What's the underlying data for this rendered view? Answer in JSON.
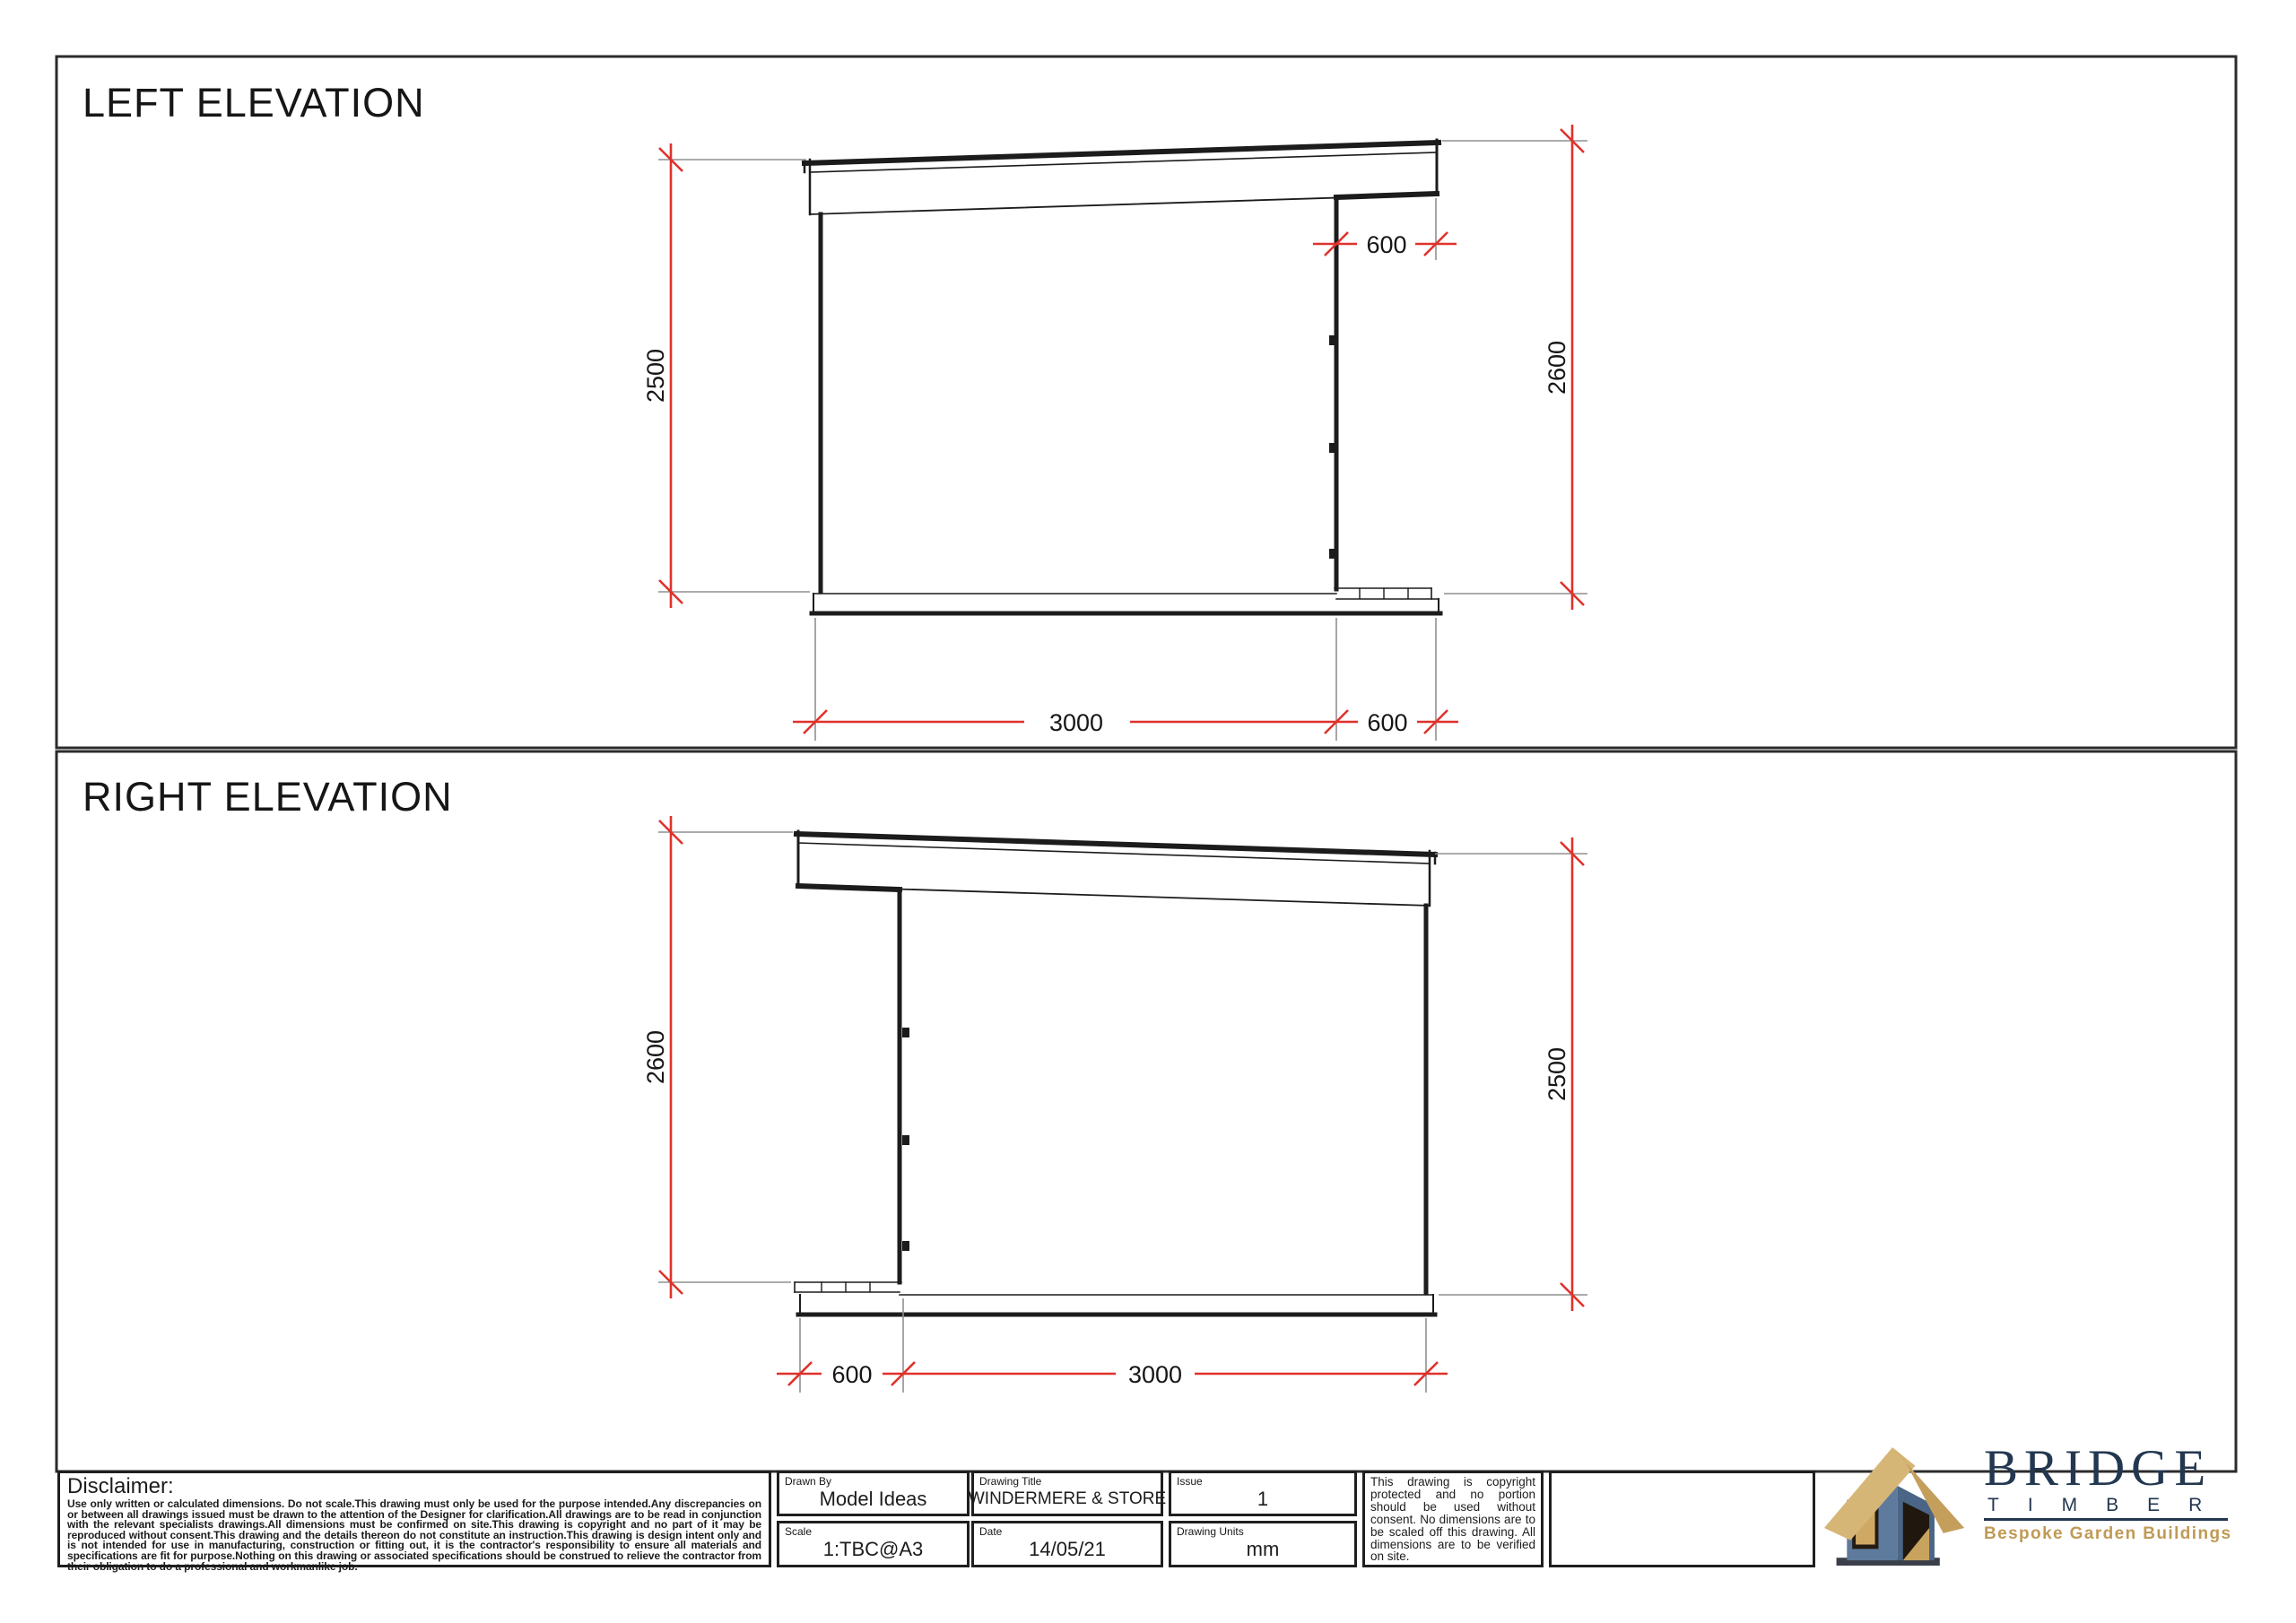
{
  "sheet": {
    "drawing_type": "elevation sheet"
  },
  "colors": {
    "dimension_red": "#e0312b",
    "extension_gray": "#8f8f8f",
    "line_black": "#1c1c1c",
    "logo_navy": "#233750",
    "logo_gold": "#c09a55",
    "logo_roof_tan": "#d6b677",
    "logo_wall_blue": "#5e7a9c"
  },
  "elevations": {
    "left": {
      "title": "LEFT ELEVATION",
      "dim_left_height": "2500",
      "dim_right_height": "2600",
      "dim_overhang_top": "600",
      "dim_width": "3000",
      "dim_overhang_bottom": "600"
    },
    "right": {
      "title": "RIGHT ELEVATION",
      "dim_left_height": "2600",
      "dim_right_height": "2500",
      "dim_overhang_bottom": "600",
      "dim_width": "3000"
    }
  },
  "title_block": {
    "disclaimer_heading": "Disclaimer:",
    "disclaimer_body": "Use only written or calculated dimensions. Do not scale.This drawing must only be used for the purpose intended.Any discrepancies on or between all drawings issued must be drawn to the attention of the Designer for clarification.All drawings are to be read in conjunction with the relevant specialists drawings.All dimensions must be confirmed on site.This drawing is copyright and no part of it may be reproduced without consent.This drawing and the details thereon do not constitute an instruction.This drawing is design intent only and is not intended for use in manufacturing, construction or fitting out, it is the contractor's responsibility to ensure all materials and specifications are fit for purpose.Nothing on this drawing or associated specifications should be construed to relieve the contractor from their obligation to do a professional and workmanlike job.",
    "fields": [
      {
        "label": "Drawn By",
        "value": "Model Ideas"
      },
      {
        "label": "Drawing Title",
        "value": "WINDERMERE & STORE"
      },
      {
        "label": "Issue",
        "value": "1"
      },
      {
        "label": "Scale",
        "value": "1:TBC@A3"
      },
      {
        "label": "Date",
        "value": "14/05/21"
      },
      {
        "label": "Drawing Units",
        "value": "mm"
      }
    ],
    "copyright_note": "This drawing is copyright protected and no portion should be used without consent. No dimensions are to be scaled off this drawing. All dimensions are to be verified on site."
  },
  "logo": {
    "brand": "BRIDGE",
    "sub_brand": "TIMBER",
    "tagline": "Bespoke Garden Buildings"
  }
}
